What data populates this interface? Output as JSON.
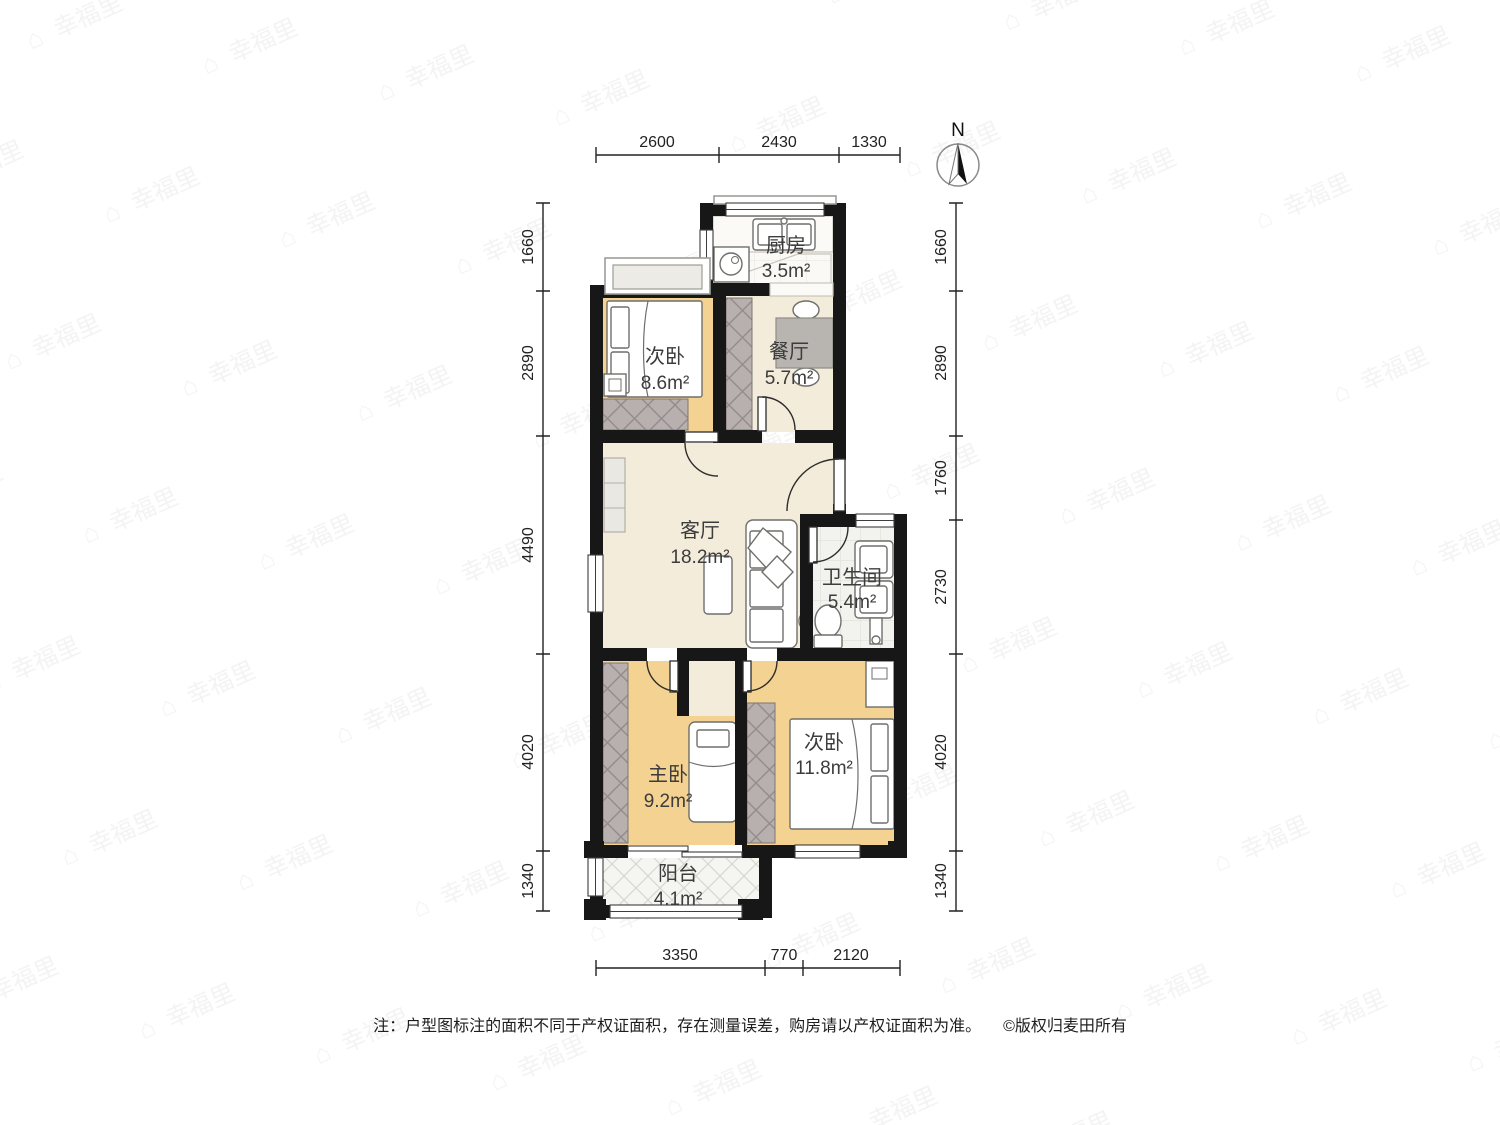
{
  "watermark": {
    "icon": "⌂",
    "text": "幸福里"
  },
  "compass": {
    "label": "N"
  },
  "rooms": [
    {
      "id": "kitchen",
      "name": "厨房",
      "area": "3.5m²"
    },
    {
      "id": "bedroom-top-left",
      "name": "次卧",
      "area": "8.6m²"
    },
    {
      "id": "dining",
      "name": "餐厅",
      "area": "5.7m²"
    },
    {
      "id": "living",
      "name": "客厅",
      "area": "18.2m²"
    },
    {
      "id": "bathroom",
      "name": "卫生间",
      "area": "5.4m²"
    },
    {
      "id": "master-bedroom",
      "name": "主卧",
      "area": "9.2m²"
    },
    {
      "id": "bedroom-bottom-right",
      "name": "次卧",
      "area": "11.8m²"
    },
    {
      "id": "balcony",
      "name": "阳台",
      "area": "4.1m²"
    }
  ],
  "dimensions": {
    "top": [
      "2600",
      "2430",
      "1330"
    ],
    "bottom": [
      "3350",
      "770",
      "2120"
    ],
    "left": [
      "1660",
      "2890",
      "4490",
      "4020",
      "1340"
    ],
    "right": [
      "1660",
      "2890",
      "1760",
      "2730",
      "4020",
      "1340"
    ]
  },
  "footer": {
    "note": "注：户型图标注的面积不同于产权证面积，存在测量误差，购房请以产权证面积为准。",
    "copyright": "©版权归麦田所有"
  },
  "colors": {
    "wall": "#171717",
    "wood": "#f4d291",
    "beige": "#f3ecda",
    "hatch": "#b7b0af",
    "table": "#b8b4b0"
  }
}
